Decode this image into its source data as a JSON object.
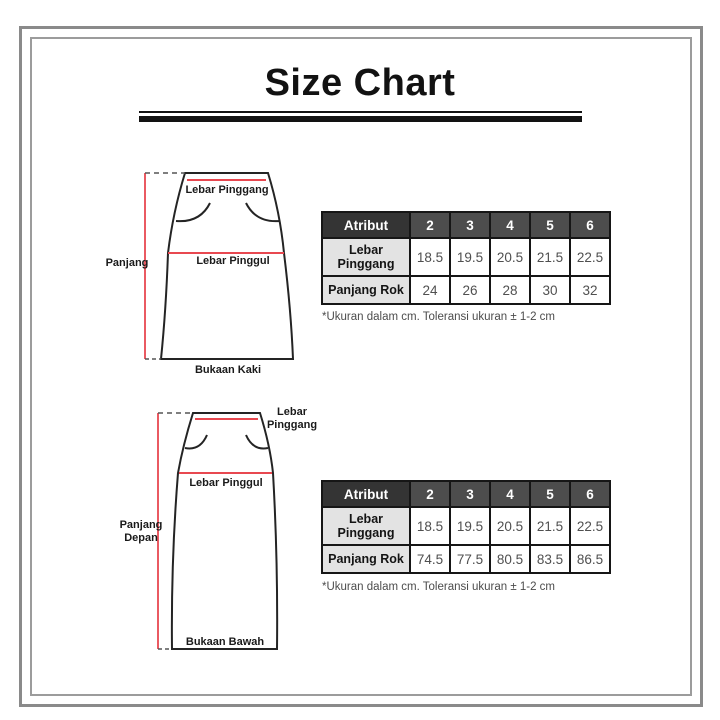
{
  "title": "Size Chart",
  "diagrams": [
    {
      "waist_label": "Lebar Pinggang",
      "hip_label": "Lebar Pinggul",
      "length_label": "Panjang",
      "opening_label": "Bukaan Kaki"
    },
    {
      "waist_label": "Lebar Pinggang",
      "hip_label": "Lebar Pinggul",
      "length_label": "Panjang Depan",
      "opening_label": "Bukaan Bawah"
    }
  ],
  "tables": [
    {
      "header": [
        "Atribut",
        "2",
        "3",
        "4",
        "5",
        "6"
      ],
      "rows": [
        {
          "label": "Lebar Pinggang",
          "values": [
            "18.5",
            "19.5",
            "20.5",
            "21.5",
            "22.5"
          ]
        },
        {
          "label": "Panjang Rok",
          "values": [
            "24",
            "26",
            "28",
            "30",
            "32"
          ]
        }
      ],
      "footnote": "*Ukuran dalam cm. Toleransi ukuran ± 1-2 cm"
    },
    {
      "header": [
        "Atribut",
        "2",
        "3",
        "4",
        "5",
        "6"
      ],
      "rows": [
        {
          "label": "Lebar Pinggang",
          "values": [
            "18.5",
            "19.5",
            "20.5",
            "21.5",
            "22.5"
          ]
        },
        {
          "label": "Panjang Rok",
          "values": [
            "74.5",
            "77.5",
            "80.5",
            "83.5",
            "86.5"
          ]
        }
      ],
      "footnote": "*Ukuran dalam cm. Toleransi ukuran ± 1-2 cm"
    }
  ],
  "colors": {
    "accent_red": "#E84850",
    "outline_black": "#242424",
    "table_header_dark": "#343434",
    "table_header_gray": "#4D4D4D",
    "row_label_bg": "#E3E3E3",
    "frame_gray": "#8A8A8A"
  }
}
